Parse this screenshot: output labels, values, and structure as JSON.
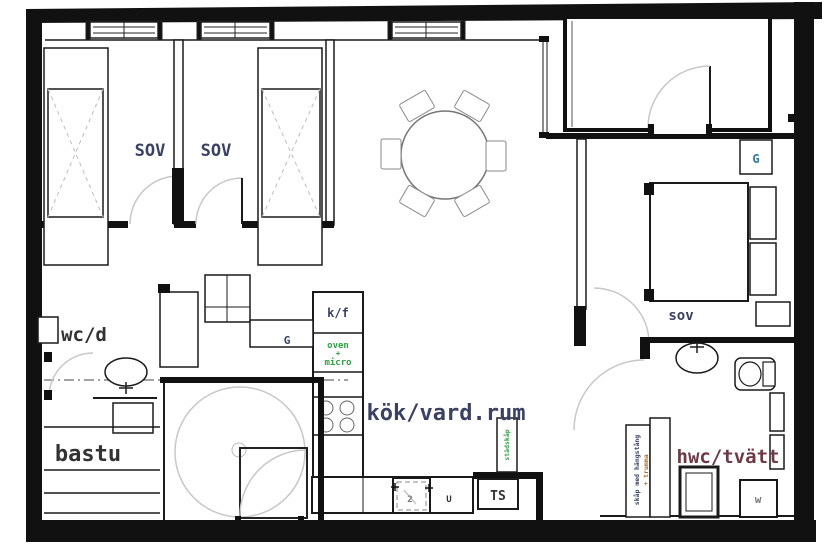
{
  "plan_type": "apartment floor plan",
  "labels": {
    "bedroom1": "SOV",
    "bedroom2": "SOV",
    "bedroom3": "sov",
    "kitchen_living": "kök/vard.rum",
    "wc_shower": "wc/d",
    "sauna": "bastu",
    "laundry_wc": "hwc/tvätt",
    "wardrobe_hall": "G",
    "wardrobe_bedroom": "G"
  },
  "appliances": {
    "fridge_freezer": "k/f",
    "oven_l1": "oven",
    "oven_l2": "+",
    "oven_l3": "micro",
    "drying_cabinet": "TS",
    "washing_machine": "w",
    "sink_unit_mark": "U",
    "dishwasher_mark": "2",
    "cleaning_cabinet_vertical": "städskåp",
    "laundry_shelf_l1": "skåp med hängstång",
    "laundry_shelf_l2": "+ trumma"
  },
  "colors": {
    "wall": "#111111",
    "label_navy": "#3a4163",
    "label_dark": "#333333",
    "label_maroon": "#6e3a45",
    "label_green": "#2f9e44",
    "label_teal": "#2e7da0",
    "door_arc": "#c8c8c8"
  }
}
